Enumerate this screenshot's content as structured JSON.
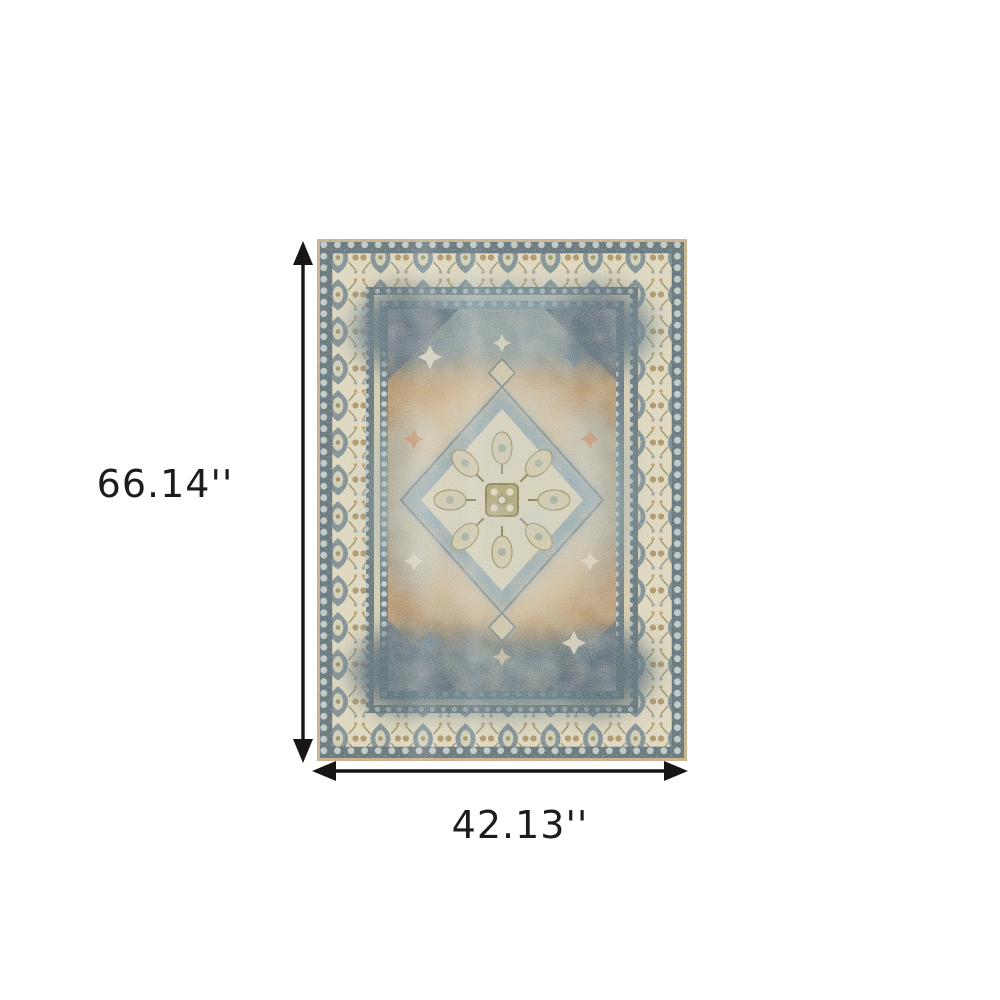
{
  "page": {
    "background_color": "#ffffff"
  },
  "diagram": {
    "type": "product-dimensions",
    "height_label": "66.14''",
    "width_label": "42.13''",
    "arrow_color": "#161616",
    "label_color": "#1c1c1c"
  },
  "product_image": {
    "description": "Vintage oriental medallion area rug in ivory, tan and slate blue with ornate floral borders",
    "palette": {
      "edge_trim": "#c2a87e",
      "guard_band": "#54666f",
      "band_dot": "#b9c4c3",
      "border_cream": "#dcd4bb",
      "motif_blue": "#5f7683",
      "motif_tan": "#a58a5b",
      "motif_olive": "#8a8a5a",
      "field_tan": "#b18c5f",
      "field_blue": "#7e98a4",
      "field_navy": "#4c5f6b",
      "medallion_cream": "#d7d1ba",
      "accent_rust": "#bf7e55"
    }
  }
}
